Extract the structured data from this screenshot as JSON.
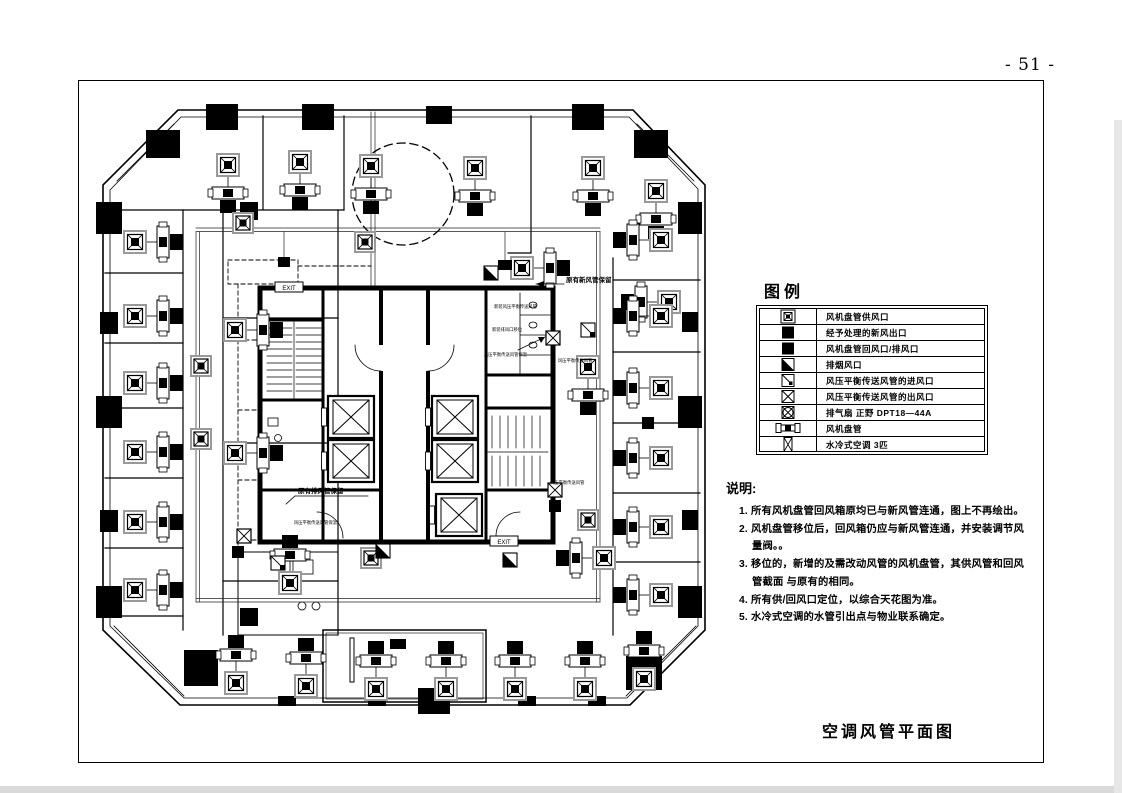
{
  "page": {
    "number": "- 51 -",
    "drawing_title": "空调风管平面图"
  },
  "legend": {
    "heading": "图例",
    "rows": [
      {
        "icon": "fan-coil-supply-outlet-icon",
        "label": "风机盘管供风口"
      },
      {
        "icon": "treated-fresh-air-outlet-icon",
        "label": "经予处理的新风出口"
      },
      {
        "icon": "fan-coil-return-exhaust-outlet-icon",
        "label": "风机盘管回风口/排风口"
      },
      {
        "icon": "smoke-exhaust-outlet-icon",
        "label": "排烟风口"
      },
      {
        "icon": "pressure-balance-duct-inlet-icon",
        "label": "风压平衡传送风管的进风口"
      },
      {
        "icon": "pressure-balance-duct-outlet-icon",
        "label": "风压平衡传送风管的出风口"
      },
      {
        "icon": "exhaust-fan-icon",
        "label": "排气扇 正野 DPT18—44A"
      },
      {
        "icon": "fan-coil-unit-icon",
        "label": "风机盘管"
      },
      {
        "icon": "water-cooled-ac-icon",
        "label": "水冷式空调 3匹"
      }
    ]
  },
  "notes": {
    "heading": "说明:",
    "items": [
      "1. 所有风机盘管回风箱原均已与新风管连通，图上不再绘出。",
      "2. 风机盘管移位后，回风箱仍应与新风管连通，并安装调节风量阀。。",
      "3. 移位的，新增的及需改动风管的风机盘管，其供风管和回风管截面 与原有的相同。",
      "4. 所有供/回风口定位，以综合天花图为准。",
      "5. 水冷式空调的水管引出点与物业联系确定。"
    ]
  },
  "plan": {
    "annotations": {
      "fresh_air_retained": "原有新风管保留",
      "exhaust_retained": "原有排风管保留",
      "pressure_insulation_1": "风压平衡传送风管保温",
      "pressure_insulation_2": "风压平衡传送风管保温",
      "new_pressure_duct": "新装风压平衡传送风管",
      "relocate_note": "新装排风口移位",
      "pressure_duct": "风压平衡传送风管",
      "exit": "EXIT"
    }
  }
}
